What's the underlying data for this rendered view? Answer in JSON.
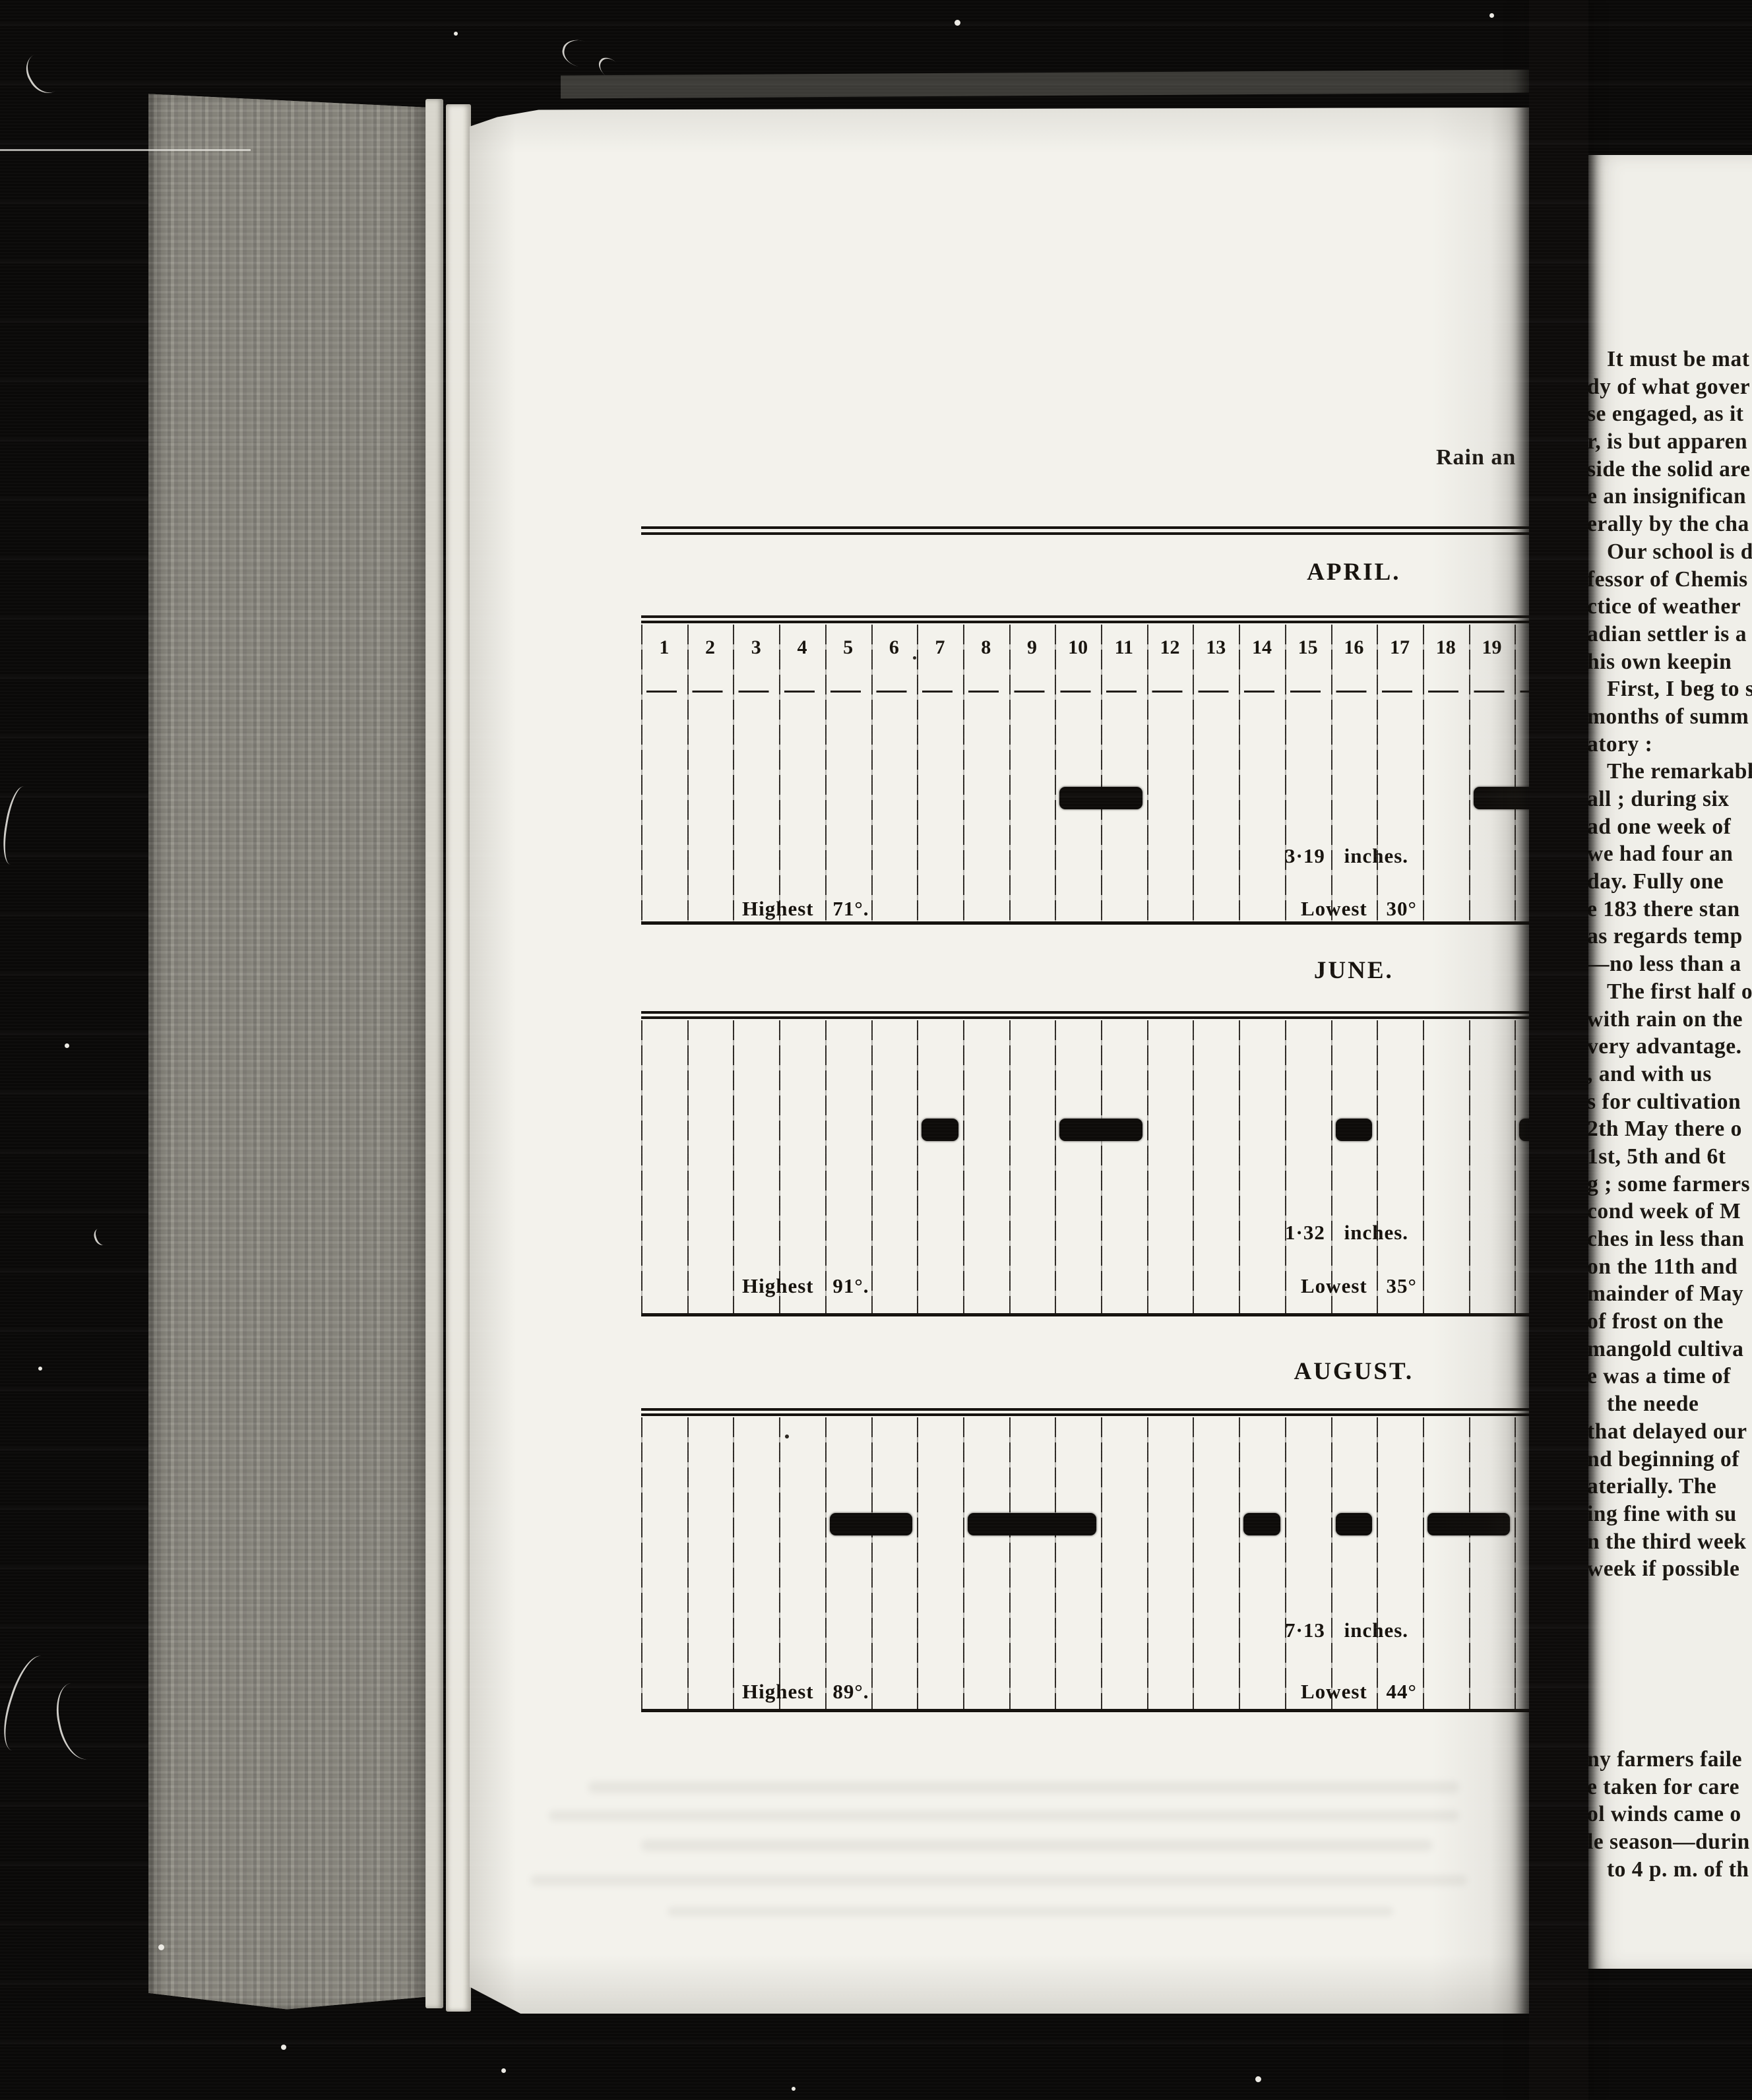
{
  "left_page": {
    "running_header": "Rain an",
    "description": "Rain chart table for months, one column per day, black bars mark rainy days"
  },
  "chart_data": [
    {
      "type": "bar",
      "title": "APRIL.",
      "xlabel": "day of month",
      "visible_day_labels": [
        "1",
        "2",
        "3",
        "4",
        "5",
        "6",
        "7",
        "8",
        "9",
        "10",
        "11",
        "12",
        "13",
        "14",
        "15",
        "16",
        "17",
        "18",
        "19"
      ],
      "rain_day_spans": [
        {
          "from": 10,
          "to": 11
        },
        {
          "from": 19,
          "to": 20,
          "cut_by_scan_edge": true
        }
      ],
      "rainfall_total_label": "3·19 inches.",
      "rainfall_total_inches": 3.19,
      "highest_label": "Highest 71°.",
      "highest_temp_f": 71,
      "lowest_label": "Lowest 30°",
      "lowest_temp_f": 30
    },
    {
      "type": "bar",
      "title": "JUNE.",
      "xlabel": "day of month",
      "visible_day_labels": [],
      "rain_day_spans": [
        {
          "from": 7,
          "to": 7
        },
        {
          "from": 10,
          "to": 11
        },
        {
          "from": 16,
          "to": 16
        },
        {
          "from": 20,
          "to": 20,
          "cut_by_scan_edge": true
        }
      ],
      "rainfall_total_label": "1·32 inches.",
      "rainfall_total_inches": 1.32,
      "highest_label": "Highest 91°.",
      "highest_temp_f": 91,
      "lowest_label": "Lowest 35°",
      "lowest_temp_f": 35
    },
    {
      "type": "bar",
      "title": "AUGUST.",
      "xlabel": "day of month",
      "visible_day_labels": [],
      "rain_day_spans": [
        {
          "from": 5,
          "to": 6
        },
        {
          "from": 8,
          "to": 10
        },
        {
          "from": 14,
          "to": 14
        },
        {
          "from": 16,
          "to": 16
        },
        {
          "from": 18,
          "to": 19
        }
      ],
      "rainfall_total_label": "7·13 inches.",
      "rainfall_total_inches": 7.13,
      "highest_label": "Highest 89°.",
      "highest_temp_f": 89,
      "lowest_label": "Lowest 44°",
      "lowest_temp_f": 44
    }
  ],
  "right_page": {
    "paragraph_lines": [
      {
        "t": "It must be mat",
        "indent": true
      },
      {
        "t": "dy of what gover",
        "indent": false
      },
      {
        "t": "se engaged, as it",
        "indent": false
      },
      {
        "t": "r, is but apparen",
        "indent": false
      },
      {
        "t": "side the solid are",
        "indent": false
      },
      {
        "t": "e an insignifican",
        "indent": false
      },
      {
        "t": "erally by the cha",
        "indent": false
      },
      {
        "t": "Our school is d",
        "indent": true
      },
      {
        "t": "fessor of Chemis",
        "indent": false
      },
      {
        "t": "ctice of weather",
        "indent": false
      },
      {
        "t": "adian settler is a",
        "indent": false
      },
      {
        "t": "his own keepin",
        "indent": false
      },
      {
        "t": "First, I beg to s",
        "indent": true
      },
      {
        "t": "months of summ",
        "indent": false
      },
      {
        "t": "atory :",
        "indent": false
      },
      {
        "t": "The remarkable",
        "indent": true
      },
      {
        "t": "all ; during six",
        "indent": false
      },
      {
        "t": "ad one week of",
        "indent": false
      },
      {
        "t": "we had four an",
        "indent": false
      },
      {
        "t": "day.  Fully one",
        "indent": false
      },
      {
        "t": "e 183 there stan",
        "indent": false
      },
      {
        "t": "as regards temp",
        "indent": false
      },
      {
        "t": "—no less than a",
        "indent": false
      },
      {
        "t": "The first half of",
        "indent": true
      },
      {
        "t": "with rain on the",
        "indent": false
      },
      {
        "t": "very advantage.",
        "indent": false
      },
      {
        "t": ", and  with  us",
        "indent": false
      },
      {
        "t": "s for cultivation",
        "indent": false
      },
      {
        "t": "2th May there o",
        "indent": false
      },
      {
        "t": "1st, 5th and 6t",
        "indent": false
      },
      {
        "t": "g ;  some farmers",
        "indent": false
      },
      {
        "t": "cond week of M",
        "indent": false
      },
      {
        "t": "ches in less than",
        "indent": false
      },
      {
        "t": "on the 11th and",
        "indent": false
      },
      {
        "t": "mainder of May",
        "indent": false
      },
      {
        "t": "of frost on the",
        "indent": false
      },
      {
        "t": "mangold   cultiva",
        "indent": false
      },
      {
        "t": "e was a time of",
        "indent": false
      },
      {
        "t": "the neede",
        "indent": true
      },
      {
        "t": "that delayed our",
        "indent": false
      },
      {
        "t": "nd beginning of",
        "indent": false
      },
      {
        "t": "aterially.   The",
        "indent": false
      },
      {
        "t": "ing fine with  su",
        "indent": false
      },
      {
        "t": "n the third week",
        "indent": false
      },
      {
        "t": "week if possible",
        "indent": false
      }
    ],
    "lower_lines": [
      {
        "t": "ny farmers faile",
        "indent": false
      },
      {
        "t": "e taken for care",
        "indent": false
      },
      {
        "t": "ol winds came o",
        "indent": false
      },
      {
        "t": "le season—durin",
        "indent": false
      },
      {
        "t": "to 4 p. m. of th",
        "indent": true
      }
    ]
  }
}
